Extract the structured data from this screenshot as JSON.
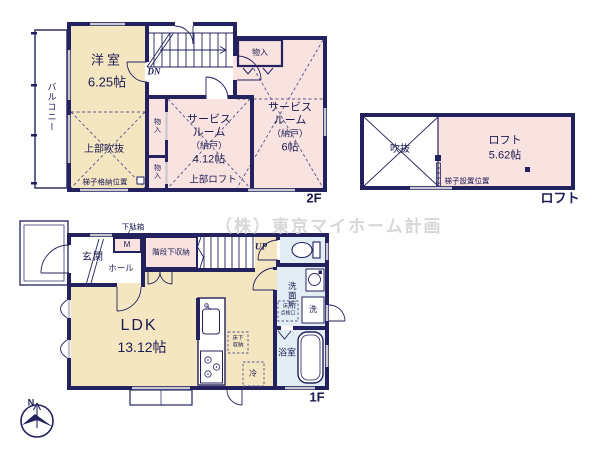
{
  "watermark": "（株）東京マイホーム計画",
  "colors": {
    "wall": "#23225f",
    "room_cream": "#f5e6c2",
    "room_pink": "#f9e3e1",
    "room_blue": "#e3edf4",
    "window_gray": "#c7c8d2",
    "text_navy": "#1c1b52"
  },
  "floor2": {
    "label": "2F",
    "balcony": "バルコニー",
    "western_room": "洋室",
    "western_room_size": "6.25帖",
    "open_above": "上部吹抜",
    "ladder_storage": "梯子格納位置",
    "dn": "DN",
    "closet_top": "物入",
    "closet_a": "物入",
    "closet_b": "物入",
    "service_mid": {
      "l1": "サービス",
      "l2": "ルーム",
      "l3": "（納戸）",
      "size": "4.12帖",
      "upper_loft": "上部ロフト"
    },
    "service_right": {
      "l1": "サービス",
      "l2": "ルーム",
      "l3": "（納戸）",
      "size": "6帖"
    }
  },
  "loft": {
    "label": "ロフト",
    "void": "吹抜",
    "room": "ロフト",
    "room_size": "5.62帖",
    "ladder_position": "梯子設置位置"
  },
  "floor1": {
    "label": "1F",
    "entrance": "玄関",
    "hall": "ホール",
    "shoe_box": "下駄箱",
    "mirror_label": "M",
    "under_stair_storage": "階段下収納",
    "up": "UP",
    "ldk": "LDK",
    "ldk_size": "13.12帖",
    "underfloor_storage": {
      "l1": "床下",
      "l2": "収納"
    },
    "fridge": "冷",
    "washroom": "洗面所",
    "washer": "洗",
    "inspection": {
      "l1": "床下",
      "l2": "点検口"
    },
    "bathroom": "浴室"
  },
  "compass": {
    "north": "N"
  }
}
